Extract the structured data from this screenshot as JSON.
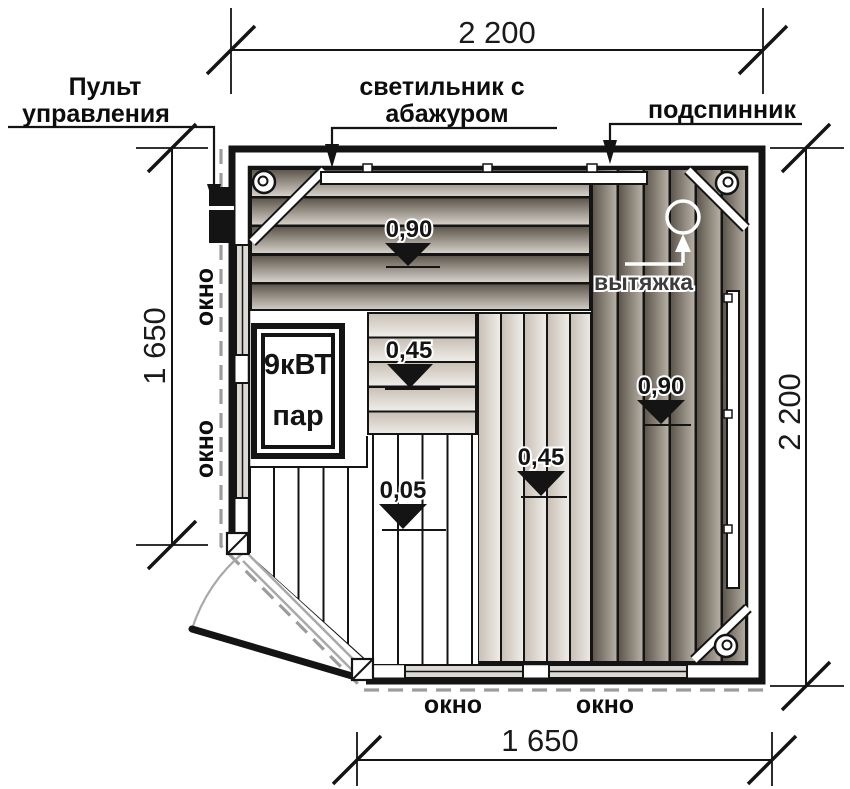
{
  "dimensions": {
    "top": "2 200",
    "left": "1 650",
    "right": "2 200",
    "bottom": "1 650"
  },
  "labels": {
    "control_panel_line1": "Пульт",
    "control_panel_line2": "управления",
    "lamp_line1": "светильник с",
    "lamp_line2": "абажуром",
    "backrest": "подспинник",
    "exhaust": "вытяжка"
  },
  "windows": {
    "left_top": "окно",
    "left_bottom": "окно",
    "bottom_left": "окно",
    "bottom_right": "окно"
  },
  "heater": {
    "power": "9кВТ",
    "medium": "пар"
  },
  "levels": {
    "top_bench": "0,90",
    "mid_bench": "0,45",
    "floor": "0,05",
    "front_bench": "0,45",
    "right_bench": "0,90"
  },
  "colors": {
    "paper": "#ffffff",
    "ink": "#141414",
    "wood_dark": "#5e574d",
    "wood_light": "#d5d0c8",
    "wood_mid": "#b6afa4",
    "wood_soft": "#c9c1b7",
    "wood_pale": "#efece7",
    "glass": "#dcd9d4",
    "dash_gray": "#9c9c9c",
    "door_gray": "#a9a9a9"
  }
}
